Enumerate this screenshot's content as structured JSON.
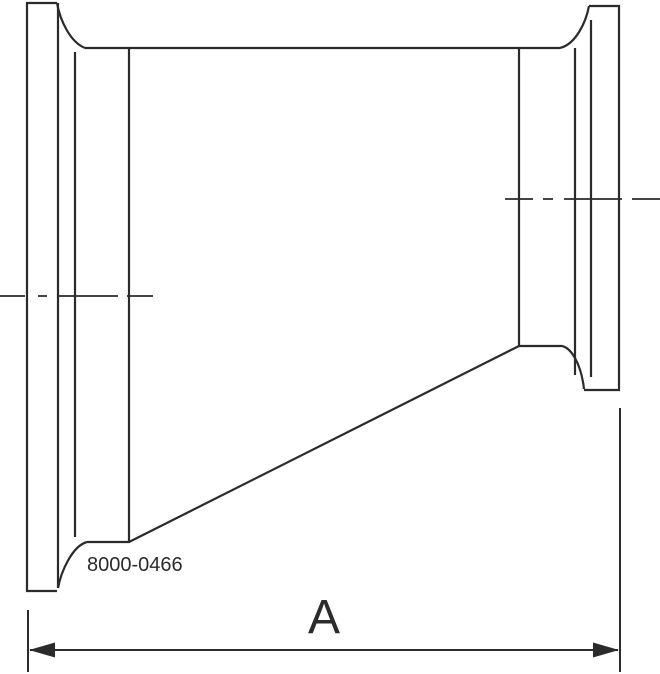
{
  "drawing": {
    "part_number": "8000-0466",
    "dimension_label": "A",
    "view": "side-profile-section",
    "component": "eccentric-reducer-with-clamp-ends"
  },
  "colors": {
    "line": "#2b2b2b",
    "background": "#ffffff"
  }
}
